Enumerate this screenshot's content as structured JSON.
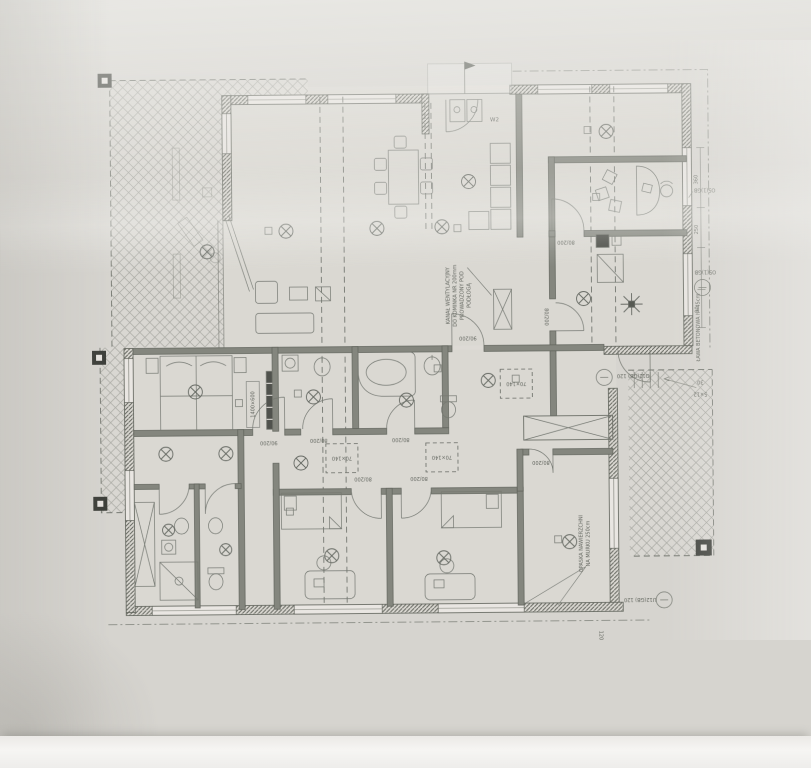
{
  "labels": {
    "door_80": "80/200",
    "door_90": "90/200",
    "skylight": "70×140",
    "window_o5": "O5(1)GB",
    "window_o12": "O12(GB) 120",
    "window_u12": "U12(GB) 120",
    "dim_30": "30",
    "dim_5x12": "5×12",
    "dim_120": "120",
    "dim_360": "360",
    "dim_250": "250",
    "dim_90": "90",
    "porch_mark": "W2",
    "radiator": "1400×600"
  },
  "notes": {
    "vent_line1": "KANAŁ WENTYLACYJNY",
    "vent_line2": "DO KOMINKA NR 200mm",
    "vent_line3": "PROWADZONY POD",
    "vent_line4": "PODŁOGĄ",
    "opaska_line1": "OPASKA NAWIERZCHNI",
    "opaska_line2": "NA MURKU 250cm",
    "lawa": "ŁAWA BETONOWA h=45cm"
  },
  "colors": {
    "paper": "#d6d4cf",
    "ink": "#5d615a",
    "wall_fill": "#7d8077",
    "highlight": "#f6f5f3",
    "shadow": "#aeaca6"
  }
}
